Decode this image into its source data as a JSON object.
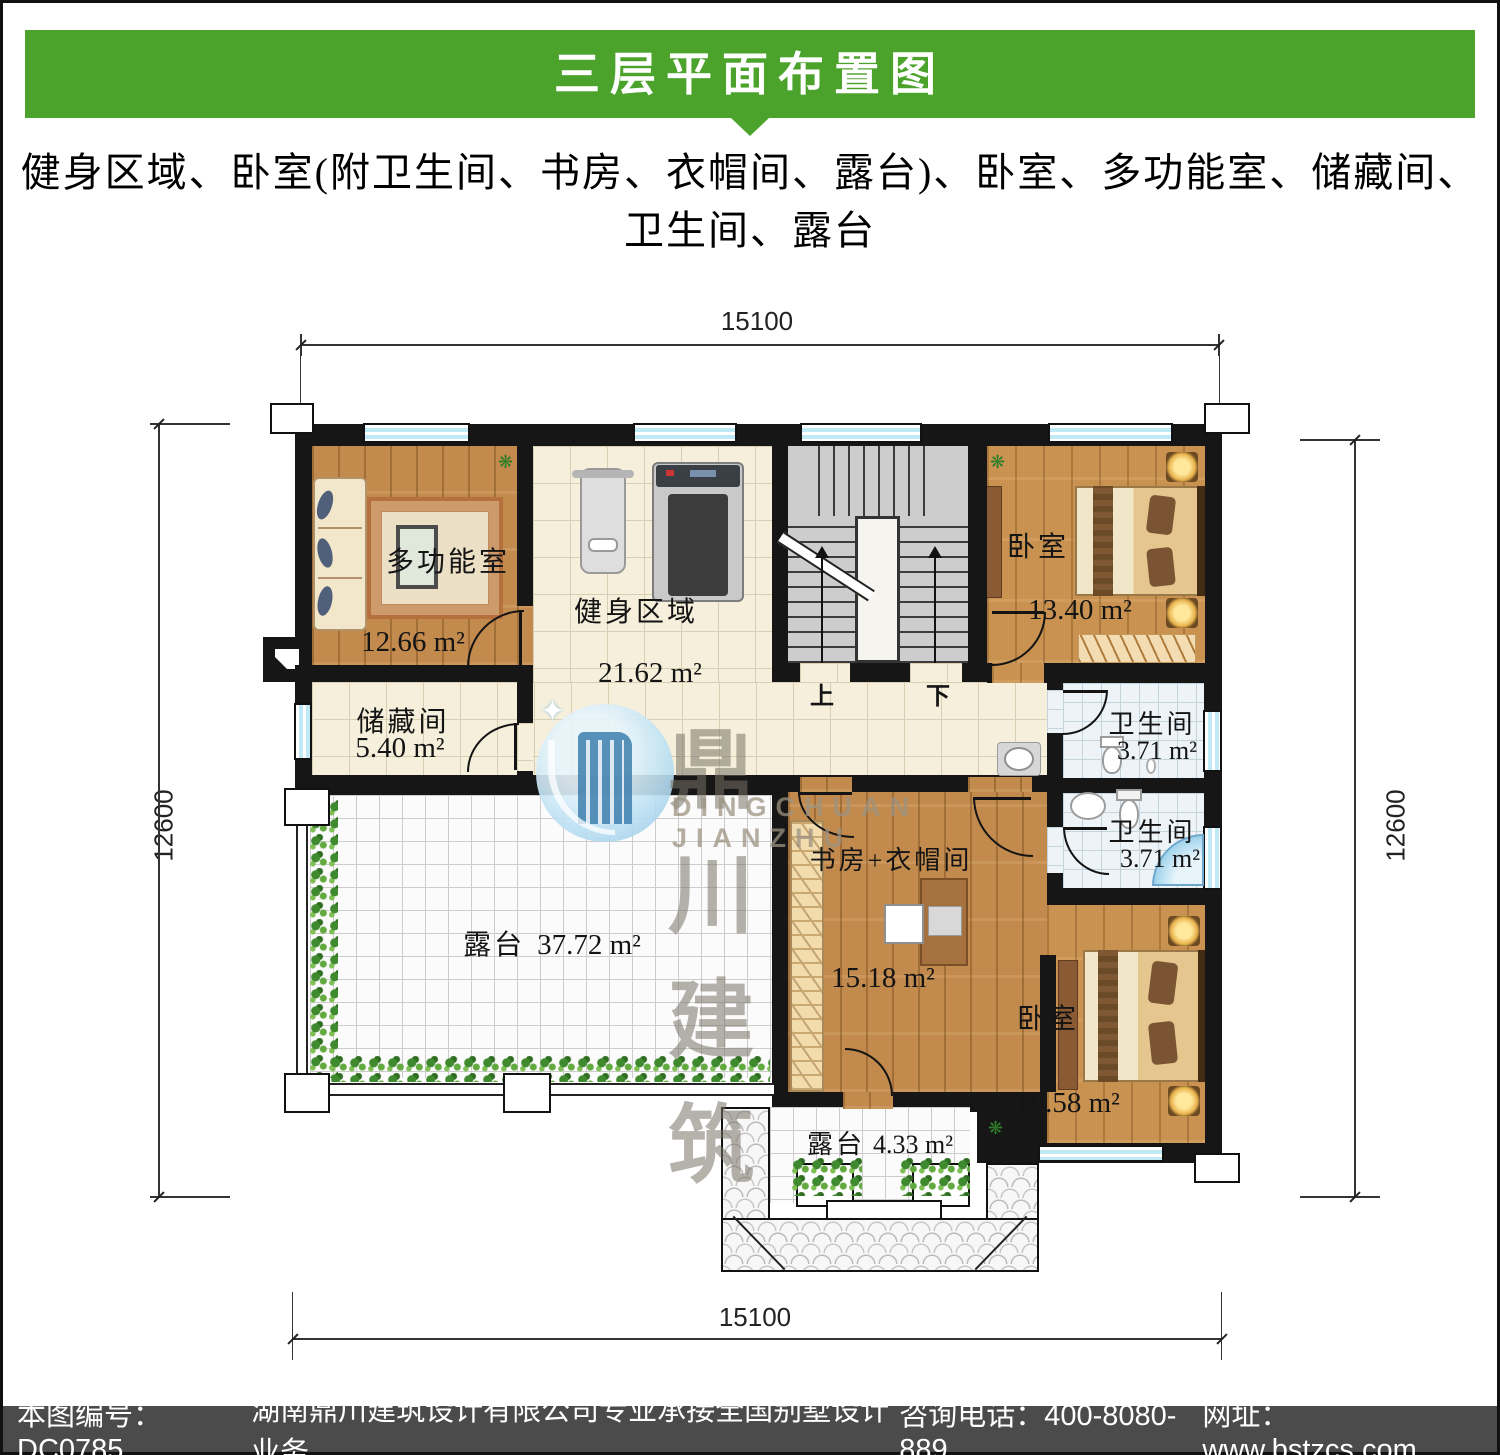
{
  "header": {
    "title": "三层平面布置图",
    "subtitle_line1": "健身区域、卧室(附卫生间、书房、衣帽间、露台)、卧室、多功能室、储藏间、",
    "subtitle_line2": "卫生间、露台"
  },
  "dimensions": {
    "top": "15100",
    "bottom": "15100",
    "left": "12600",
    "right": "12600"
  },
  "rooms": {
    "multi": {
      "name": "多功能室",
      "area": "12.66 m²"
    },
    "fitness": {
      "name": "健身区域",
      "area": "21.62 m²"
    },
    "storage": {
      "name": "储藏间",
      "area": "5.40 m²"
    },
    "bedroom1": {
      "name": "卧室",
      "area": "13.40 m²"
    },
    "bath1": {
      "name": "卫生间",
      "area": "3.71 m²"
    },
    "bath2": {
      "name": "卫生间",
      "area": "3.71 m²"
    },
    "study": {
      "name": "书房+衣帽间",
      "area": "15.18 m²"
    },
    "bedroom2": {
      "name": "卧室",
      "area": "16.58 m²"
    },
    "terrace_large": {
      "name": "露台",
      "area": "37.72 m²"
    },
    "terrace_small": {
      "name": "露台",
      "area": "4.33 m²"
    }
  },
  "stairs": {
    "up": "上",
    "down": "下"
  },
  "watermark": {
    "cn": "鼎川建筑",
    "en": "DINGCHUAN JIANZHU"
  },
  "footer": {
    "sheet_no": "本图编号：DC0785",
    "company": "湖南鼎川建筑设计有限公司专业承接全国别墅设计业务",
    "phone": "咨询电话：400-8080-889",
    "website": "网址：www.bstzcs.com"
  },
  "colors": {
    "accent_green": "#4ba32c",
    "footer_bg": "#4b4b4b",
    "wall": "#161616"
  }
}
